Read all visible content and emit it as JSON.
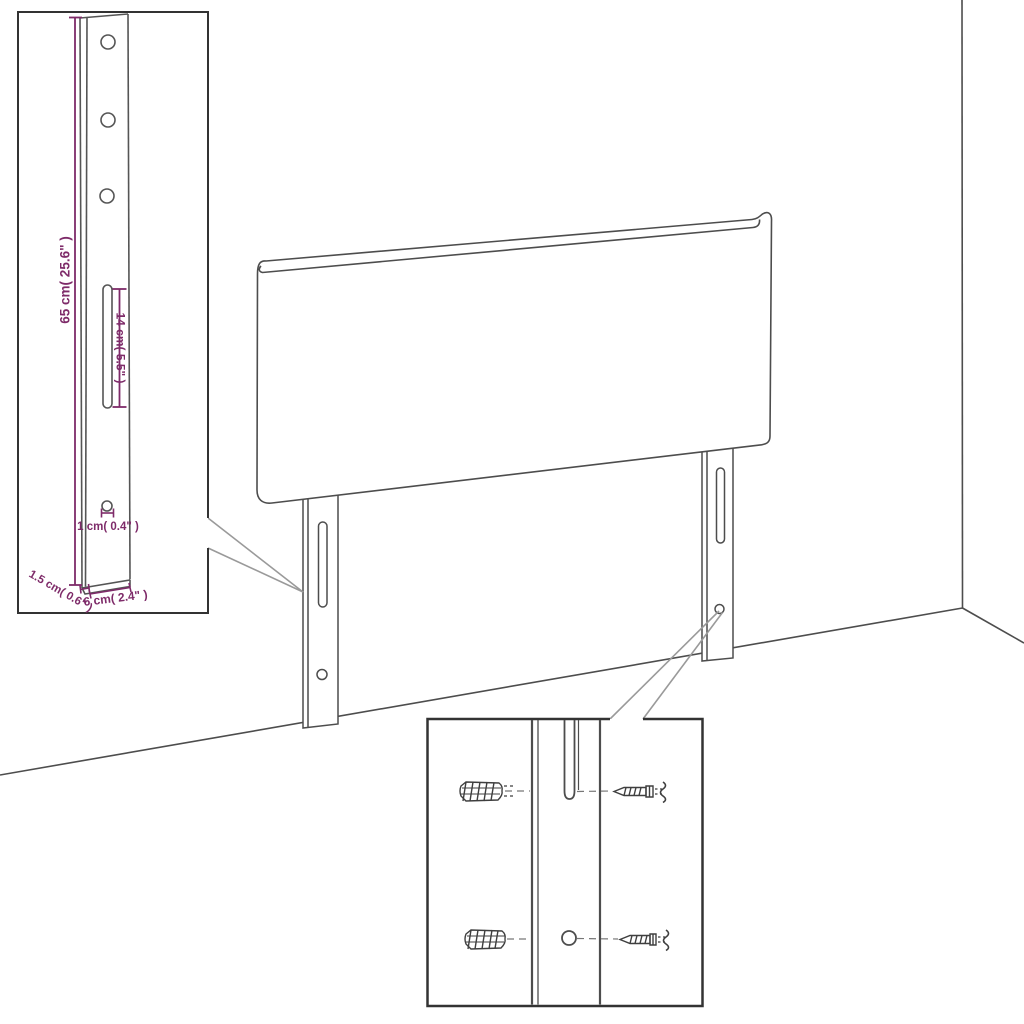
{
  "diagram": {
    "kind": "furniture-dimension-diagram",
    "subject": "headboard with two mounting legs shown against a wall corner, with a magnified leg detail inset and a magnified mounting-hardware inset"
  },
  "colors": {
    "background": "#ffffff",
    "line": "#4d4d4d",
    "box_border": "#333333",
    "callout_line": "#9a9a9a",
    "dimension": "#7e2b69"
  },
  "leg_detail_inset": {
    "height_label": "65 cm( 25.6\" )",
    "slot_label": "14 cm( 5.5\" )",
    "hole_label": "1 cm( 0.4\" )",
    "thickness_label": "1.5 cm( 0.6\" )",
    "width_label": "6 cm( 2.4\" )"
  }
}
